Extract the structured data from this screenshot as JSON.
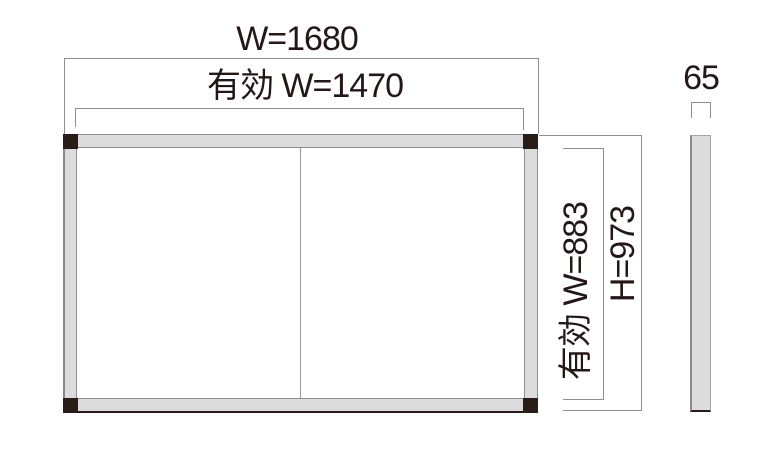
{
  "drawing": {
    "title": "panel-dimension-drawing",
    "front_view": {
      "overall_width_label": "W=1680",
      "effective_width_label": "有効 W=1470",
      "effective_height_label": "有効 W=883",
      "overall_height_label": "H=973"
    },
    "side_view": {
      "thickness_label": "65"
    },
    "colors": {
      "background": "#ffffff",
      "frame_fill": "#dcdcdc",
      "frame_edge": "#8f8f8f",
      "corner_cap": "#2a1d18",
      "dimension_line": "#8f8f8f",
      "text": "#231815"
    }
  }
}
